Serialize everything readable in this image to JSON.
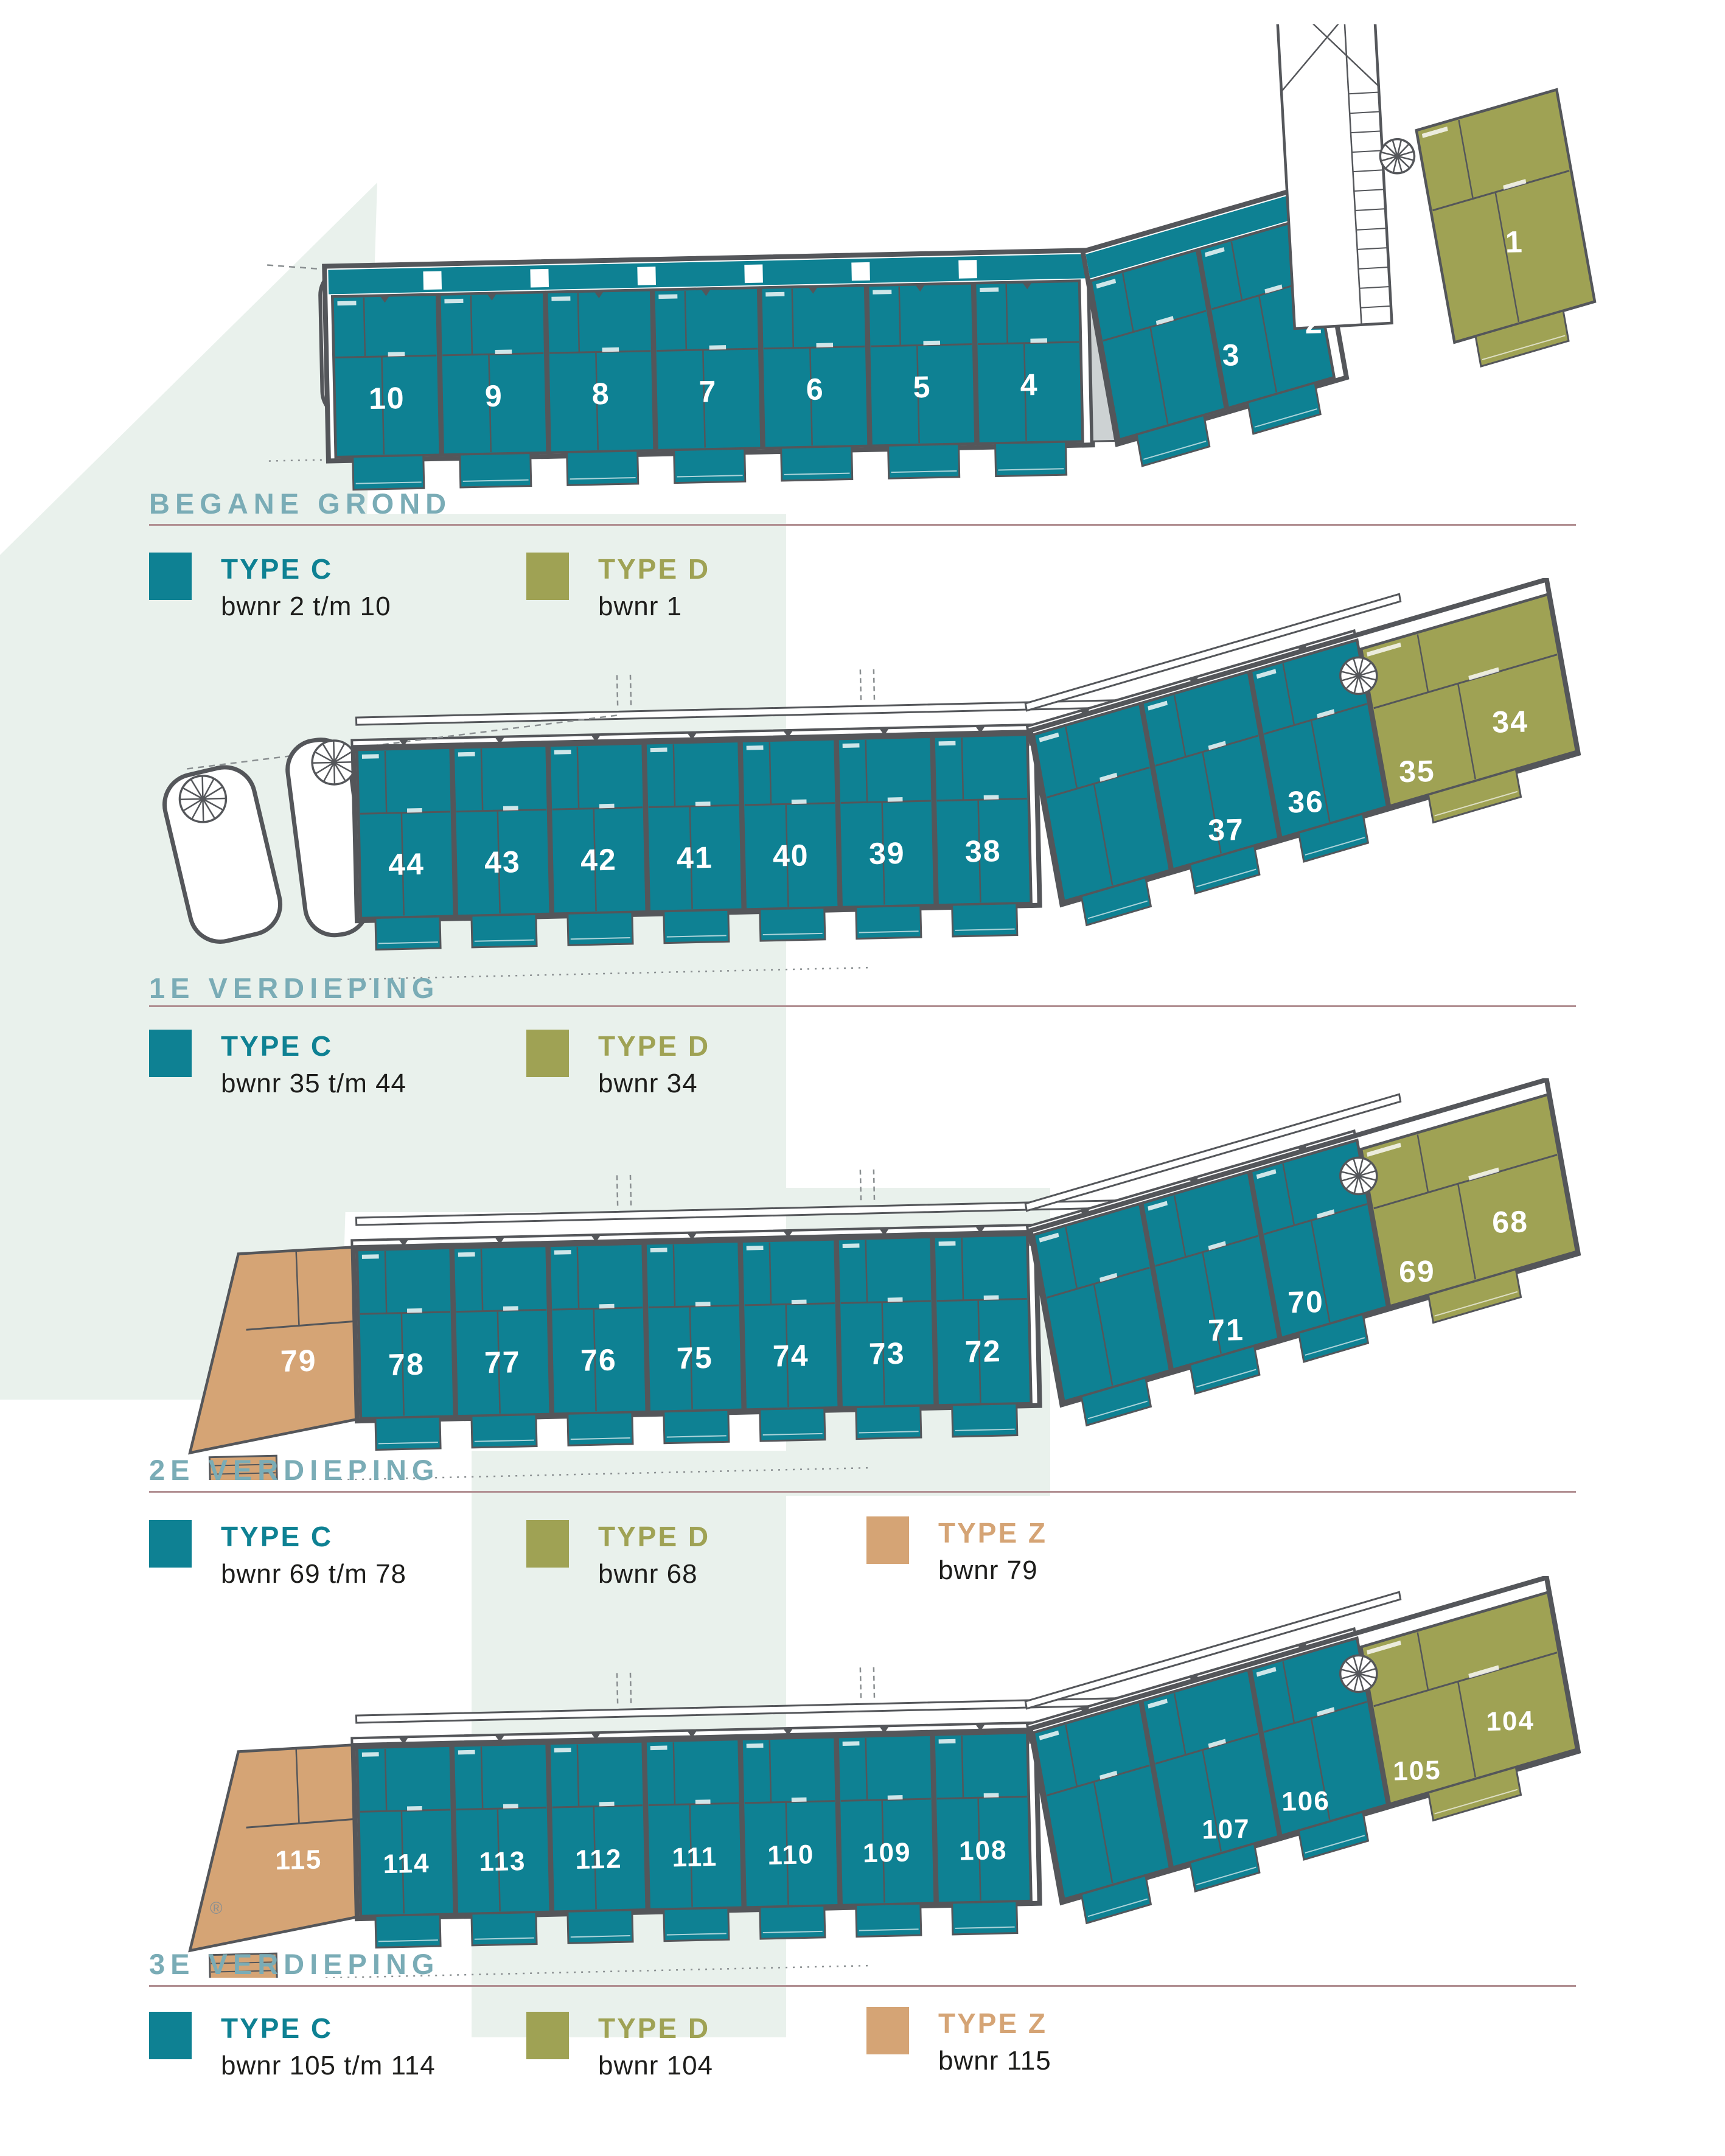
{
  "palette": {
    "type_c": "#0e8193",
    "type_d": "#9fa254",
    "type_z": "#d5a475",
    "outline": "#54565a",
    "section_title": "#7aacb6",
    "divider": "#b18f92",
    "text_dark": "#1d1d1b",
    "mint": "#e9f1ec",
    "page_bg": "#ffffff",
    "unit_number": "#ffffff",
    "leader": "#8a8f91"
  },
  "registered_mark": "®",
  "sections": [
    {
      "id": "begane-grond",
      "title": "BEGANE GROND",
      "legend": [
        {
          "type": "c",
          "label": "TYPE C",
          "range": "bwnr 2 t/m 10"
        },
        {
          "type": "d",
          "label": "TYPE D",
          "range": "bwnr 1"
        }
      ],
      "floorplan": {
        "style": "ground",
        "left_unit": null,
        "main_units": [
          "10",
          "9",
          "8",
          "7",
          "6",
          "5",
          "4"
        ],
        "wing_units": [
          {
            "label": "3",
            "type": "c"
          },
          {
            "label": "2",
            "type": "c"
          },
          {
            "label": "1",
            "type": "d"
          }
        ]
      }
    },
    {
      "id": "1e-verdieping",
      "title": "1E VERDIEPING",
      "legend": [
        {
          "type": "c",
          "label": "TYPE C",
          "range": "bwnr 35 t/m 44"
        },
        {
          "type": "d",
          "label": "TYPE D",
          "range": "bwnr 34"
        }
      ],
      "floorplan": {
        "style": "upper-spirals",
        "left_unit": null,
        "main_units": [
          "44",
          "43",
          "42",
          "41",
          "40",
          "39",
          "38"
        ],
        "wing_units": [
          {
            "label": "37",
            "type": "c"
          },
          {
            "label": "36",
            "type": "c"
          },
          {
            "label": "35",
            "type": "c"
          },
          {
            "label": "34",
            "type": "d"
          }
        ]
      }
    },
    {
      "id": "2e-verdieping",
      "title": "2E VERDIEPING",
      "legend": [
        {
          "type": "c",
          "label": "TYPE C",
          "range": "bwnr 69 t/m 78"
        },
        {
          "type": "d",
          "label": "TYPE D",
          "range": "bwnr 68"
        },
        {
          "type": "z",
          "label": "TYPE Z",
          "range": "bwnr 79"
        }
      ],
      "floorplan": {
        "style": "upper-z",
        "left_unit": {
          "label": "79",
          "type": "z"
        },
        "main_units": [
          "78",
          "77",
          "76",
          "75",
          "74",
          "73",
          "72"
        ],
        "wing_units": [
          {
            "label": "71",
            "type": "c"
          },
          {
            "label": "70",
            "type": "c"
          },
          {
            "label": "69",
            "type": "c"
          },
          {
            "label": "68",
            "type": "d"
          }
        ]
      }
    },
    {
      "id": "3e-verdieping",
      "title": "3E VERDIEPING",
      "legend": [
        {
          "type": "c",
          "label": "TYPE C",
          "range": "bwnr 105 t/m 114"
        },
        {
          "type": "d",
          "label": "TYPE D",
          "range": "bwnr 104"
        },
        {
          "type": "z",
          "label": "TYPE Z",
          "range": "bwnr 115"
        }
      ],
      "floorplan": {
        "style": "upper-z",
        "left_unit": {
          "label": "115",
          "type": "z"
        },
        "main_units": [
          "114",
          "113",
          "112",
          "111",
          "110",
          "109",
          "108"
        ],
        "wing_units": [
          {
            "label": "107",
            "type": "c"
          },
          {
            "label": "106",
            "type": "c"
          },
          {
            "label": "105",
            "type": "c"
          },
          {
            "label": "104",
            "type": "d"
          }
        ]
      }
    }
  ]
}
